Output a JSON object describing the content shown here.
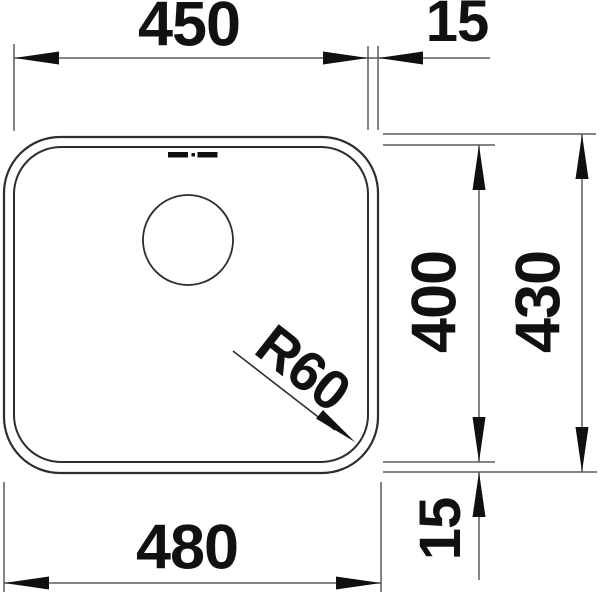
{
  "drawing": {
    "type": "technical-dimension-drawing",
    "subject": "undermount sink bowl, top view",
    "labels": {
      "top_width": "450",
      "top_flange": "15",
      "inner_height": "400",
      "outer_height": "430",
      "bottom_width": "480",
      "bottom_flange": "15",
      "corner_radius": "R60"
    },
    "colors": {
      "background": "#ffffff",
      "outline": "#2d2d2d",
      "dimension_line": "#5b5b5b",
      "arrow_and_text": "#101010"
    }
  }
}
